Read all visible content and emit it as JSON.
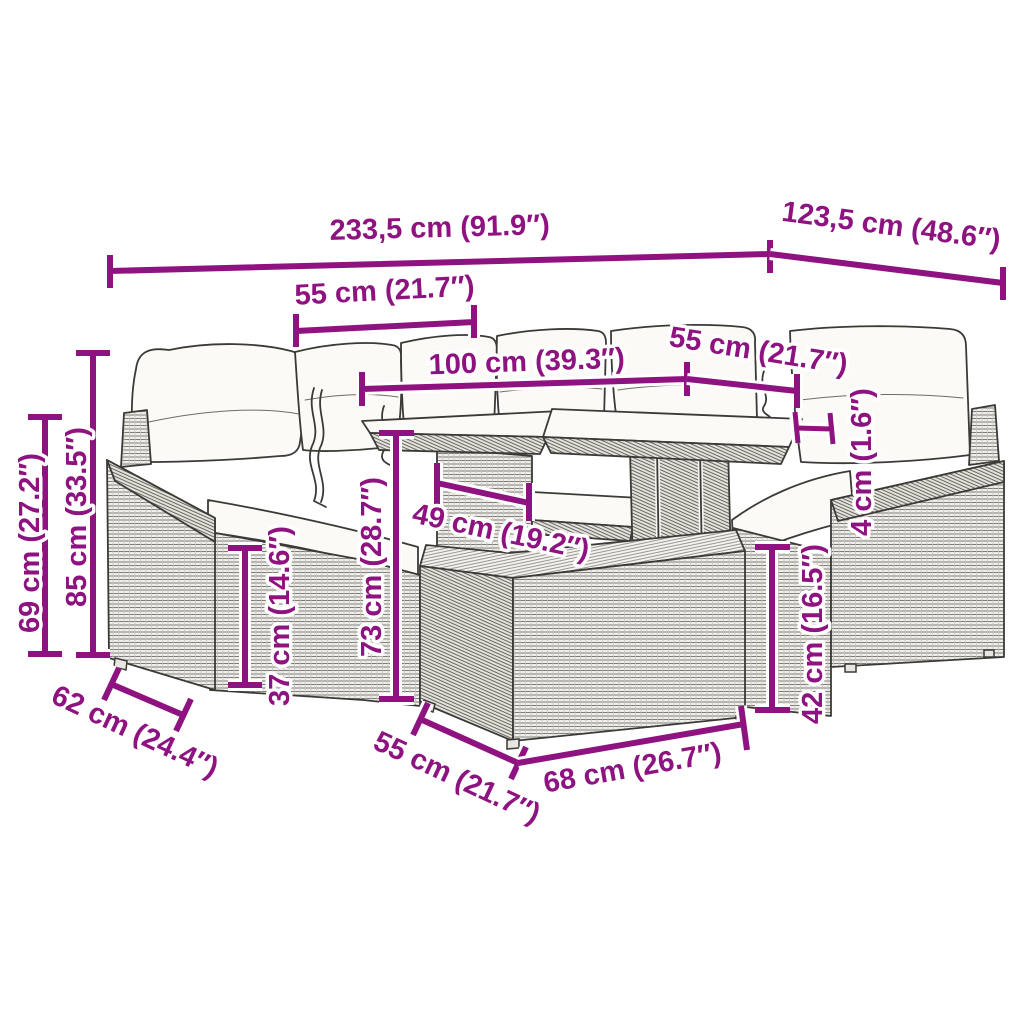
{
  "meta": {
    "background": "#ffffff",
    "accent_color": "#8E1380",
    "line_color": "#3b3a37",
    "illustration": "poly rattan garden lounge set with glass-top table and footstool, technical dimension drawing"
  },
  "dims": {
    "total_width": "233,5 cm (91.9″)",
    "total_depth": "123,5 cm (48.6″)",
    "seat_width_left": "55 cm (21.7″)",
    "table_length": "100 cm (39.3″)",
    "seat_width_right": "55 cm (21.7″)",
    "height_back": "69 cm (27.2″)",
    "height_total": "85 cm (33.5″)",
    "height_seat": "37 cm (14.6″)",
    "height_table": "73 cm (28.7″)",
    "table_clear_width": "49 cm (19.2″)",
    "glass_thickness": "4 cm (1.6″)",
    "height_footstool": "42 cm (16.5″)",
    "depth_seat": "62 cm (24.4″)",
    "footstool_depth": "55 cm (21.7″)",
    "footstool_width": "68 cm (26.7″)"
  }
}
